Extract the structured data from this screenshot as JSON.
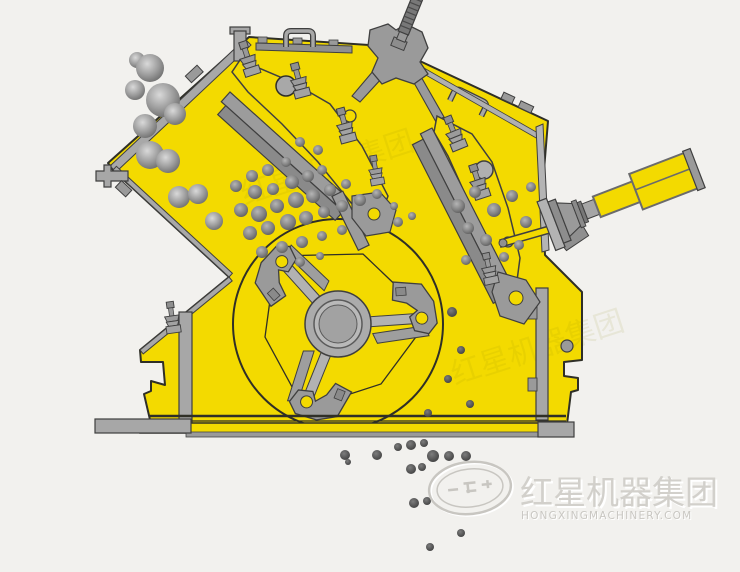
{
  "diagram": {
    "watermark": {
      "logo": "oval-globe-emblem",
      "text_cn": "红星机器集团",
      "text_en": "HONGXINGMACHINERY.COM"
    },
    "colors": {
      "background": "#f2f1ee",
      "machine_body": "#f3da00",
      "outline": "#2f2f27",
      "metal": "#a7a7a7",
      "rock": "#8a8a8a",
      "crushed_material": "#4f4f4f",
      "watermark": "#cbc9c4"
    }
  }
}
